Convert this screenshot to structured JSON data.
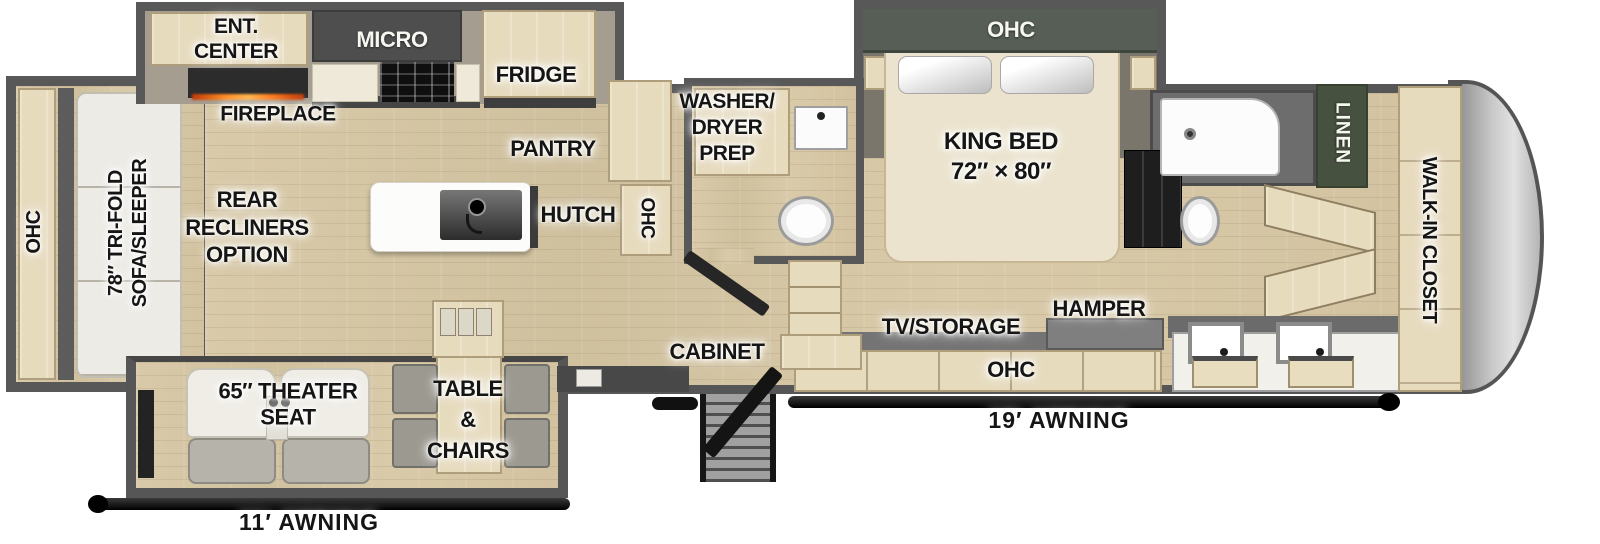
{
  "palette": {
    "wall": "#565656",
    "floor": "#d6c7a6",
    "cabinet": "#e7dbbe",
    "dark_green": "#4b5347",
    "awning_black": "#111111"
  },
  "labels": {
    "ent_center": [
      "ENT.",
      "CENTER"
    ],
    "micro": "MICRO",
    "fridge": "FRIDGE",
    "fireplace": "FIREPLACE",
    "pantry": "PANTRY",
    "hutch": "HUTCH",
    "hutch_ohc": "OHC",
    "washer_dryer": [
      "WASHER/",
      "DRYER",
      "PREP"
    ],
    "rear_ohc": "OHC",
    "sofa": [
      "78″ TRI-FOLD",
      "SOFA/SLEEPER"
    ],
    "recliners": [
      "REAR",
      "RECLINERS",
      "OPTION"
    ],
    "king_bed": [
      "KING BED",
      "72″ × 80″"
    ],
    "bedroom_ohc": "OHC",
    "tv_storage": "TV/STORAGE",
    "hamper": "HAMPER",
    "dresser_ohc": "OHC",
    "cabinet": "CABINET",
    "linen": "LINEN",
    "walk_in_closet": "WALK-IN CLOSET",
    "theater_seat": [
      "65″ THEATER",
      "SEAT"
    ],
    "table_chairs": [
      "TABLE",
      "&",
      "CHAIRS"
    ],
    "awning_door": "19′ AWNING",
    "awning_rear": "11′ AWNING"
  }
}
